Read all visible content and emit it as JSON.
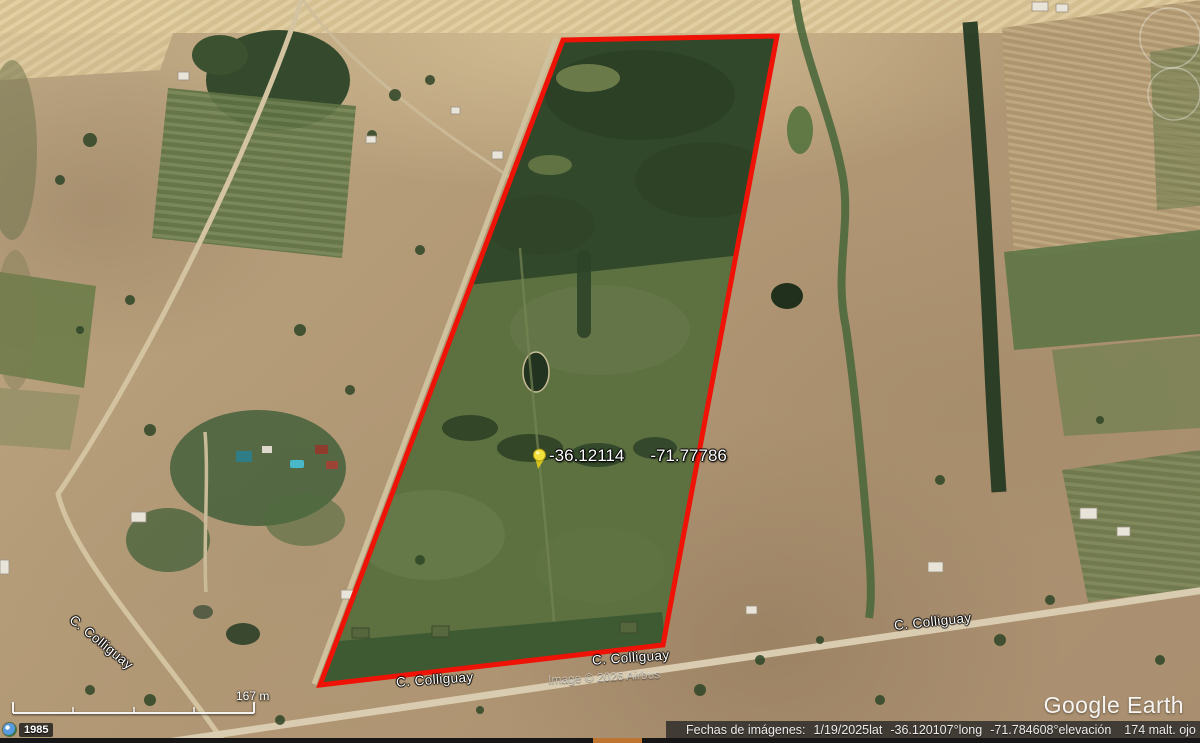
{
  "pin": {
    "lat": "-36.12114",
    "lon": "-71.77786"
  },
  "street_labels": [
    "C. Colliguay",
    "C. Colliguay",
    "C. Colliguay",
    "C. Colliguay"
  ],
  "credit": "Image © 2026 Airbus",
  "watermark": "Google Earth",
  "scale": {
    "label": "167 m"
  },
  "history": {
    "year": "1985"
  },
  "status": {
    "dates_label": "Fechas de imágenes:",
    "dates_value": "1/19/2025",
    "lat_label": "lat",
    "lat_value": "-36.120107°",
    "long_label": "long",
    "long_value": "-71.784608°",
    "elev_label": "elevación",
    "elev_value": "174 m",
    "eye_label": "alt. ojo",
    "eye_value": "914 m"
  },
  "colors": {
    "boundary_red": "#ee1306",
    "pin_yellow": "#f2e13a",
    "highlight_orange": "#bf7430",
    "stream_icon_blue": "#4a90d9"
  }
}
